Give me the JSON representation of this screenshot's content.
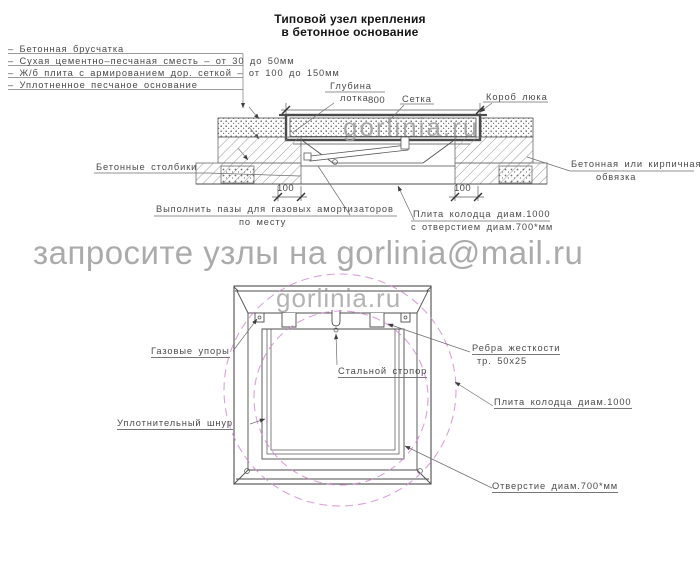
{
  "title": {
    "line1": "Типовой узел крепления",
    "line2": "в бетонное основание"
  },
  "legend": {
    "items": [
      "–  Бетонная брусчатка",
      "–  Сухая цементно–песчаная сместь  –  от 30 до 50мм",
      "–  Ж/б плита с армированием дор. сеткой  –  от 100 до 150мм",
      "–  Уплотненное песчаное основание"
    ]
  },
  "section": {
    "depth1": "Глубина",
    "depth2": "лотка",
    "dim800": "800",
    "mesh": "Сетка",
    "box": "Короб люка",
    "posts": "Бетонные столбики",
    "dim100_left": "100",
    "dim100_right": "100",
    "note1": "Выполнить пазы для газовых амортизаторов",
    "note2": "по месту",
    "plate1": "Плита колодца диам.1000",
    "plate2": "с отверстием диам.700*мм",
    "edging1": "Бетонная или кирпичная",
    "edging2": "обвязка"
  },
  "plan": {
    "gas": "Газовые упоры",
    "stopper": "Стальной стопор",
    "ribs1": "Ребра жесткости",
    "ribs2": "тр. 50х25",
    "cord": "Уплотнительный шнур",
    "plate": "Плита колодца диам.1000",
    "hole": "Отверстие диам.700*мм"
  },
  "watermarks": {
    "banner": "запросите узлы на gorlinia@mail.ru",
    "site_section": "gorlinia.ru",
    "site_plan": "gorlinia.ru"
  },
  "colors": {
    "line": "#4d4d4d",
    "hatch": "#8f8f8f",
    "magenta_dashed_circles": "#cf8ad0",
    "watermark": "#ababab"
  }
}
